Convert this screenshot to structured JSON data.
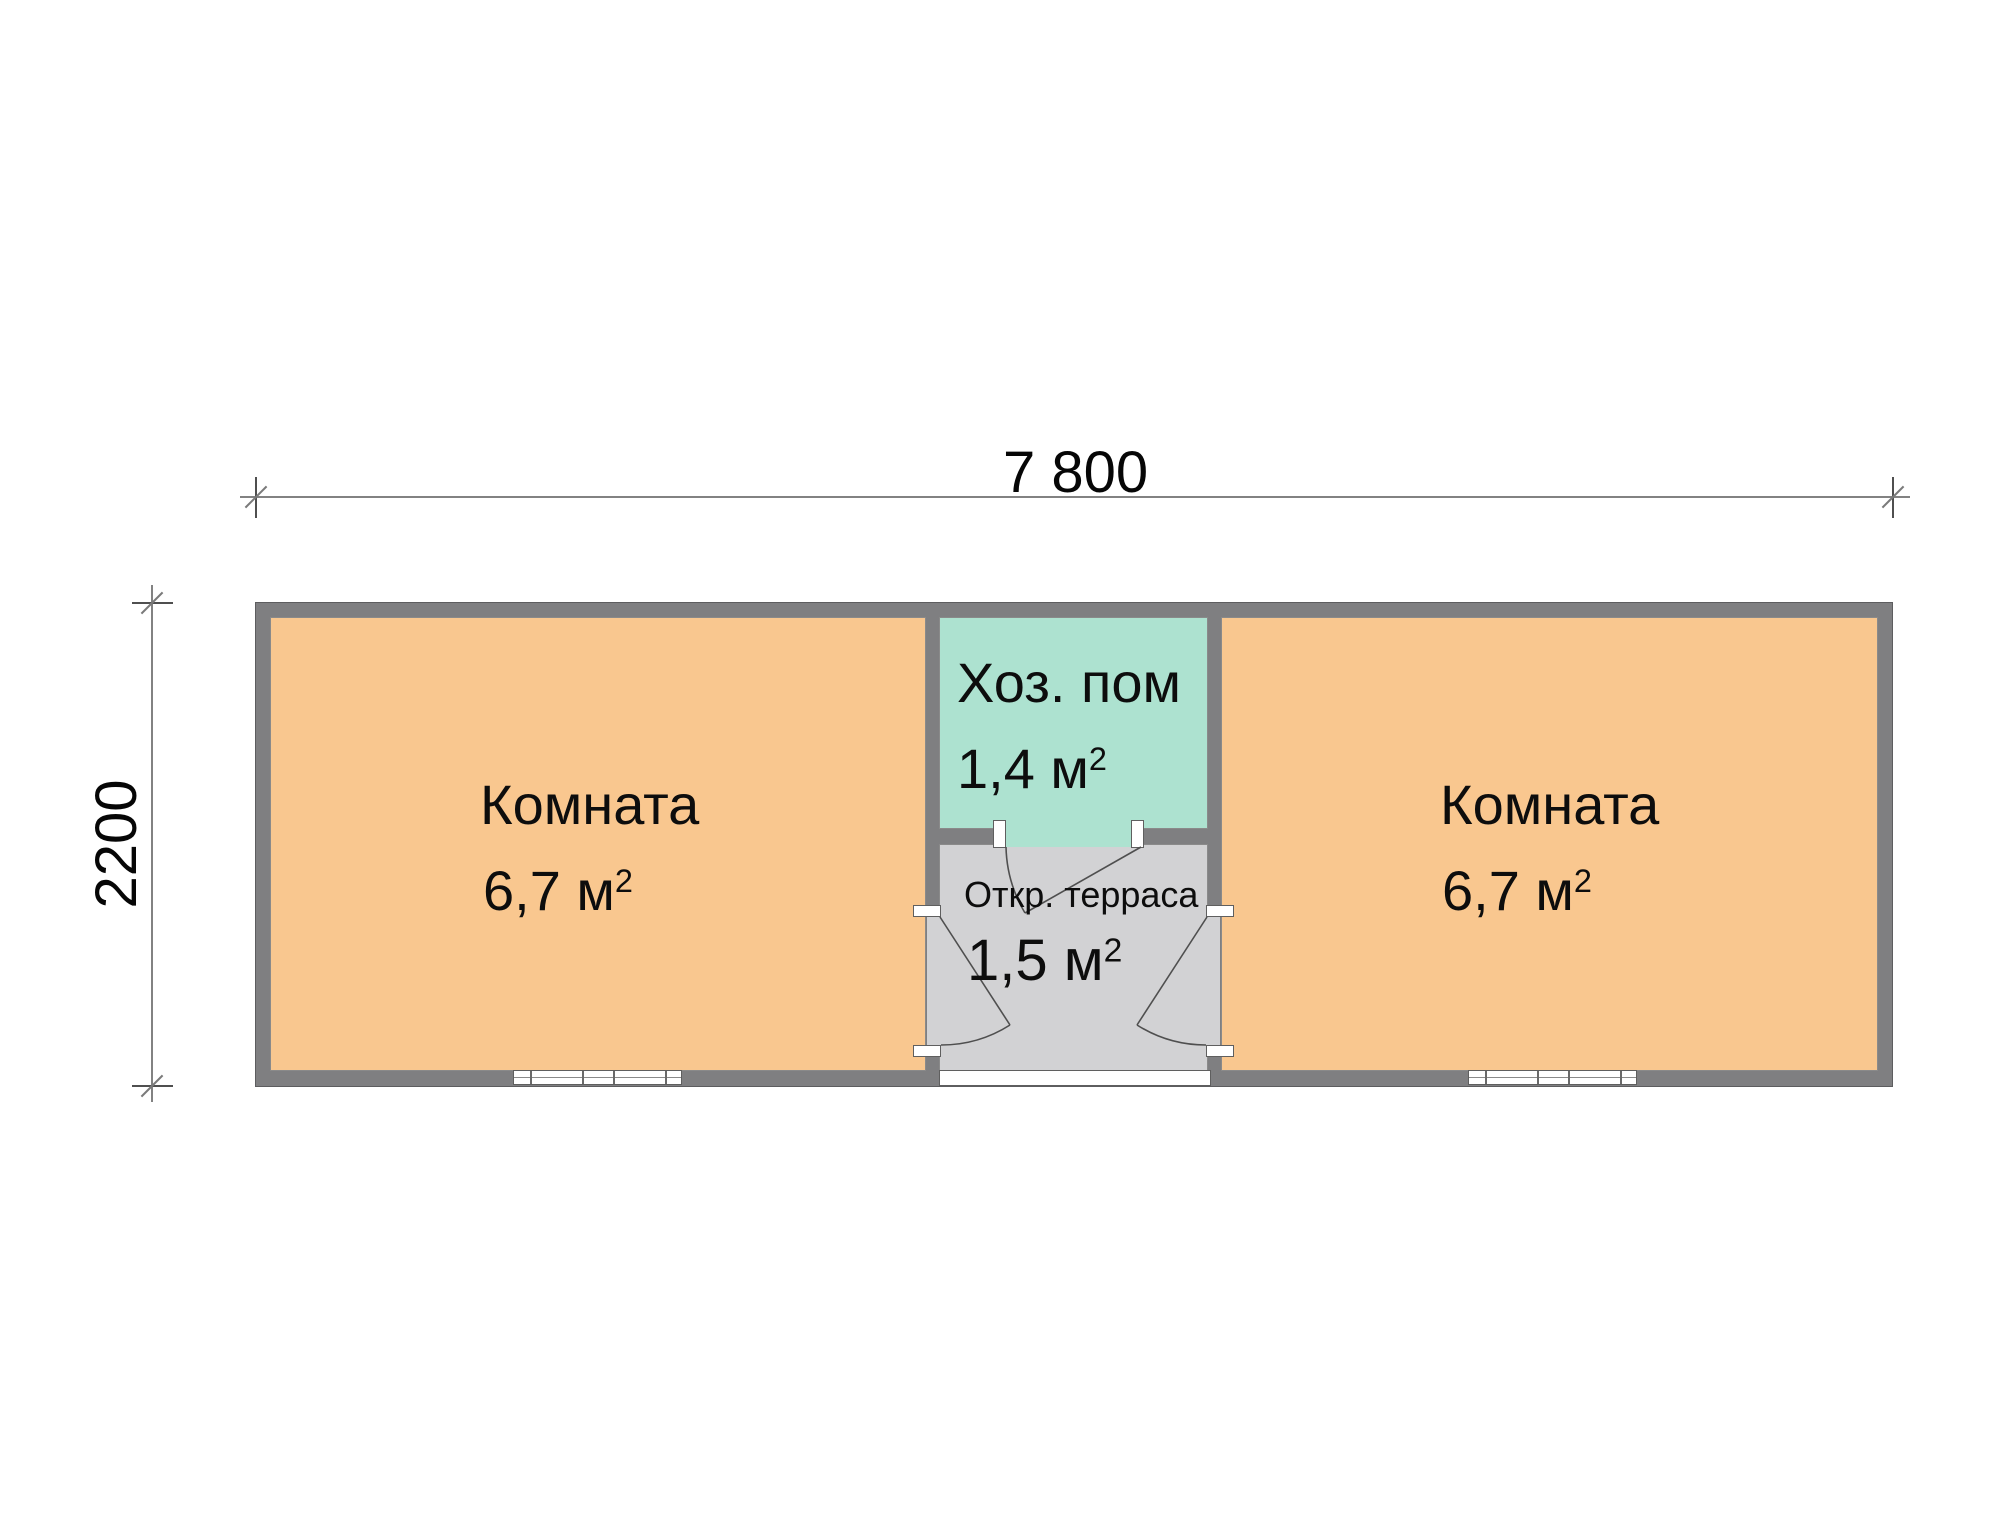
{
  "plan": {
    "title": "floor plan of a 7800x2200 modular cabin",
    "dimensions": {
      "width_label": "7 800",
      "height_label": "2200"
    },
    "rooms": {
      "room_left": {
        "name": "Комната",
        "area_text": "6,7 м",
        "area_sup": "2"
      },
      "room_right": {
        "name": "Комната",
        "area_text": "6,7 м",
        "area_sup": "2"
      },
      "utility": {
        "name": "Хоз. пом",
        "area_text": "1,4 м",
        "area_sup": "2"
      },
      "terrace": {
        "name": "Откр. терраса",
        "area_text": "1,5 м",
        "area_sup": "2"
      }
    },
    "colors": {
      "room_fill": "#f9c78f",
      "utility_fill": "#ade2d0",
      "terrace_fill": "#d2d2d4",
      "wall": "#7f7f81",
      "dimension_line": "#828282",
      "text": "#0d0d0d",
      "background": "#ffffff"
    }
  }
}
